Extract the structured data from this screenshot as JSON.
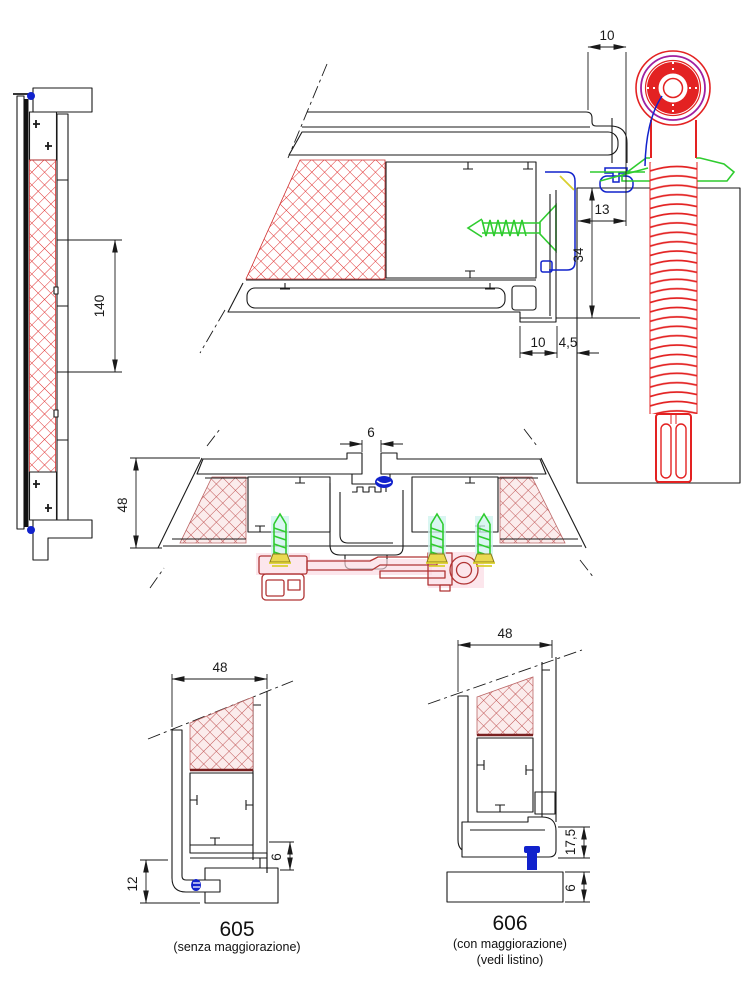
{
  "colors": {
    "red": "#e32222",
    "green": "#2fcc2f",
    "blue": "#1122cc",
    "purple": "#a020a0",
    "dark-red": "#b03434",
    "yellow": "#d9cf2e",
    "hatch-gray": "#8f8f8f",
    "line": "#1a1a1a"
  },
  "views": {
    "side_section": {
      "dim_spacing": "140"
    },
    "head_section": {
      "dim_overlap": "10",
      "dim_edge_distance": "13",
      "dim_anchor_depth": "34",
      "dim_foot": "10",
      "dim_joint_gap": "4,5"
    },
    "mullion_section": {
      "dim_gap": "6",
      "dim_depth": "48"
    },
    "detail_605": {
      "dim_depth": "48",
      "dim_recess": "12",
      "dim_gap": "6",
      "code": "605",
      "caption": "(senza maggiorazione)"
    },
    "detail_606": {
      "dim_depth": "48",
      "dim_height": "17,5",
      "dim_gap": "6",
      "code": "606",
      "caption_1": "(con maggiorazione)",
      "caption_2": "(vedi listino)"
    }
  }
}
